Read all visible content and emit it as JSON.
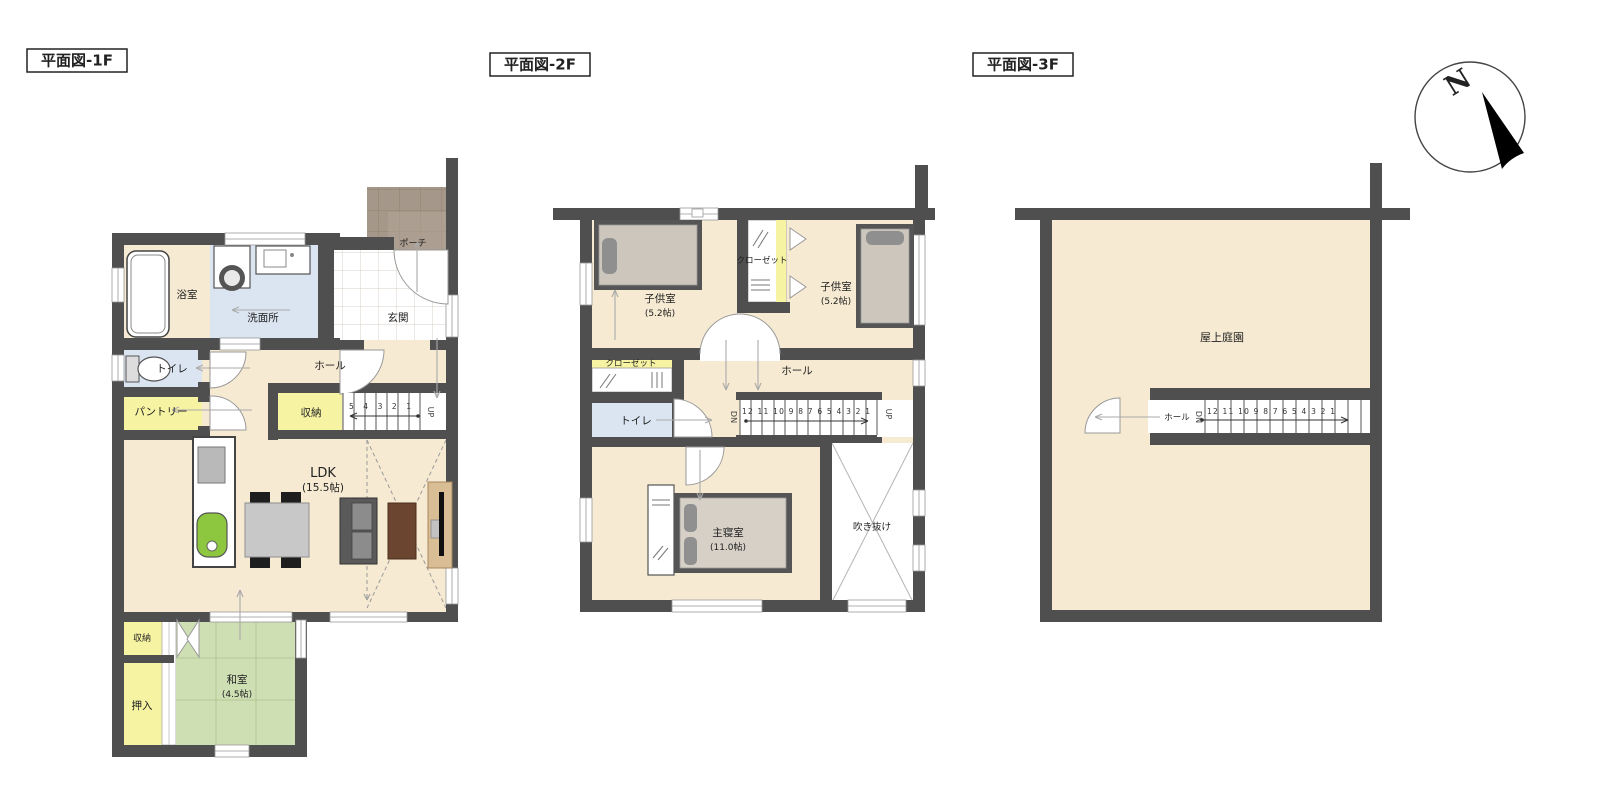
{
  "f1": {
    "title": "平面図-1F",
    "bath": "浴室",
    "washroom": "洗面所",
    "entrance": "玄関",
    "porch": "ポーチ",
    "toilet": "トイレ",
    "hall": "ホール",
    "pantry": "パントリー",
    "storage": "収納",
    "stair_numbers": "5 4 3 2 1",
    "up": "UP",
    "ldk": "LDK",
    "ldk_size": "(15.5帖)",
    "storage2": "収納",
    "oshiire": "押入",
    "washitsu": "和室",
    "washitsu_size": "(4.5帖)"
  },
  "f2": {
    "title": "平面図-2F",
    "kids1": "子供室",
    "kids1_size": "(5.2帖)",
    "kids2": "子供室",
    "kids2_size": "(5.2帖)",
    "closet_center": "クローゼット",
    "closet_left": "クローゼット",
    "toilet": "トイレ",
    "hall": "ホール",
    "dn": "DN",
    "up": "UP",
    "stair_numbers": "12 11 10 9 8 7 6 5 4 3 2 1",
    "master": "主寝室",
    "master_size": "(11.0帖)",
    "void": "吹き抜け"
  },
  "f3": {
    "title": "平面図-3F",
    "garden": "屋上庭園",
    "hall": "ホール",
    "dn": "DN",
    "stair_numbers": "12 11 10 9 8 7 6 5 4 3 2 1"
  },
  "compass": {
    "north": "N"
  },
  "palette": {
    "wall": "#4f4f4f",
    "floor_cream": "#f6ead2",
    "water_blue": "#dbe5f1",
    "closet_yellow": "#f6f3a2",
    "tatami_green": "#cfdfb4",
    "porch_brown": "#a5978a",
    "furniture_gray": "#ccc6bc",
    "kitchen_green": "#8dc63f"
  }
}
